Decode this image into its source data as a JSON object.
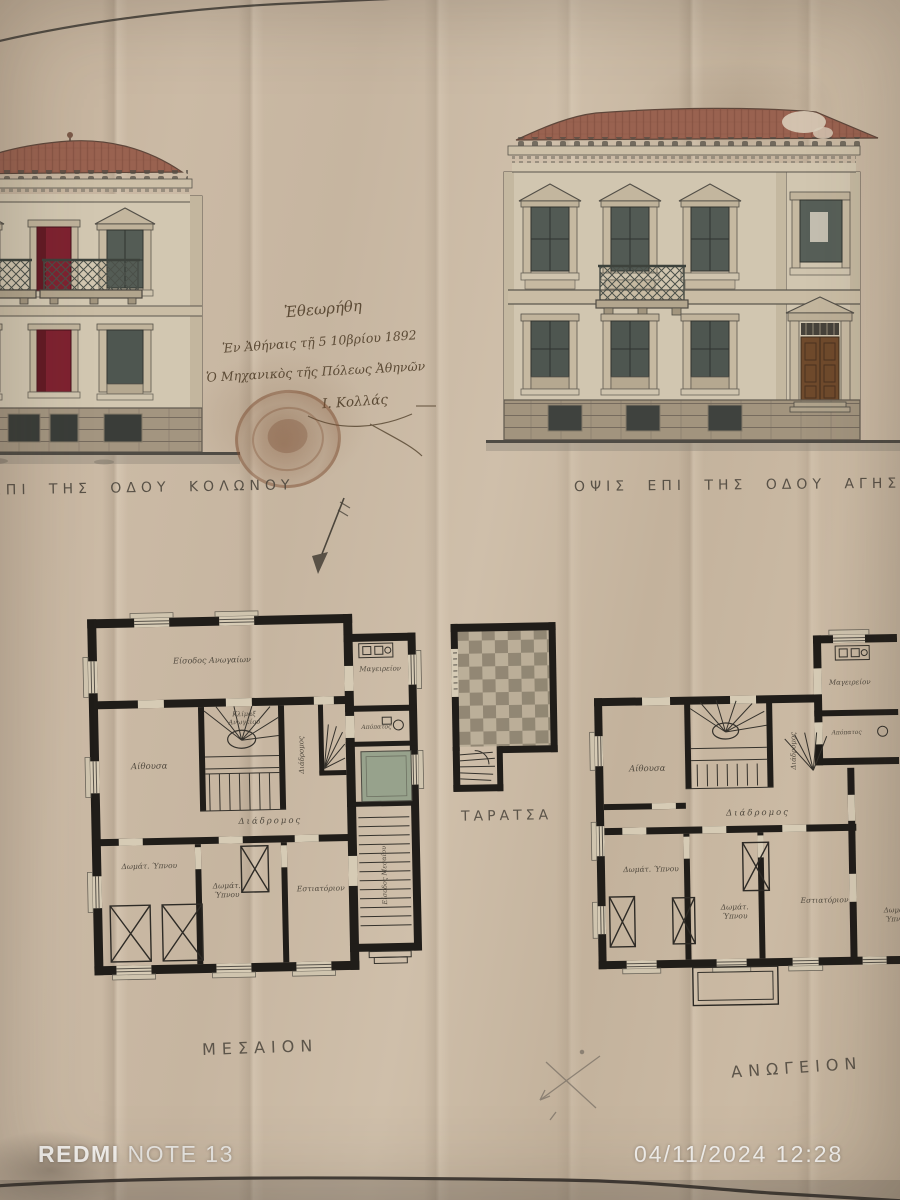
{
  "photo_overlay": {
    "device_label": {
      "brand": "REDMI",
      "model": "NOTE 13"
    },
    "datetime": "04/11/2024  12:28"
  },
  "drawing": {
    "captions": {
      "left_elevation": "ΕΠΙ ΤΗΣ ΟΔΟΥ ΚΟΛΩΝΟΥ",
      "right_elevation": "ΟΨΙΣ ΕΠΙ ΤΗΣ ΟΔΟΥ ΑΓΗΣΙΛΑΟΥ"
    },
    "approval_note": {
      "line1": "Ἐθεωρήθη",
      "line2": "Ἐν Ἀθήναις τῇ 5 10βρίου 1892",
      "line3": "Ὁ Μηχανικὸς τῆς Πόλεως Ἀθηνῶν",
      "signature": "Ι. Κολλάς"
    },
    "plans": {
      "middle_floor": {
        "title": "ΜΕΣΑΙΟΝ",
        "rooms": [
          {
            "text": "Είσοδος Ανωγαίων"
          },
          {
            "text": "Μαγειρείον"
          },
          {
            "text": "Κλίμαξ",
            "text2": "Ανωγείου"
          },
          {
            "text": "Διάδρομος"
          },
          {
            "text": "Απόπατος"
          },
          {
            "text": "Αίθουσα"
          },
          {
            "text": "Διάδρομος"
          },
          {
            "text": "Δωμάτ. Ύπνου"
          },
          {
            "text": "Δωμάτ.",
            "text2": "Ύπνου"
          },
          {
            "text": "Εστιατόριον"
          },
          {
            "text": "Είσοδος Μεσαίου"
          }
        ]
      },
      "terrace": {
        "title": "ΤΑΡΑΤΣΑ"
      },
      "upper_floor": {
        "title": "ΑΝΩΓΕΙΟΝ",
        "rooms": [
          {
            "text": "Μαγειρείον"
          },
          {
            "text": "Απόπατος"
          },
          {
            "text": "Αίθουσα"
          },
          {
            "text": "Διάδρομος"
          },
          {
            "text": "Διάδρομος"
          },
          {
            "text": "Δωμάτ. Ύπνου"
          },
          {
            "text": "Δωμάτ.",
            "text2": "Ύπνου"
          },
          {
            "text": "Εστιατόριον"
          },
          {
            "text": "Δωμάτ.",
            "text2": "Ύπνου"
          }
        ]
      }
    },
    "colors": {
      "paper": "#c7b6a1",
      "ink": "#3e3a33",
      "window_red": "#7e2230",
      "roof_tile": "#996250",
      "stamp_brown": "#8a5c44",
      "skylight_green": "#97a28c",
      "watermark_white": "#f3f1ee"
    }
  }
}
